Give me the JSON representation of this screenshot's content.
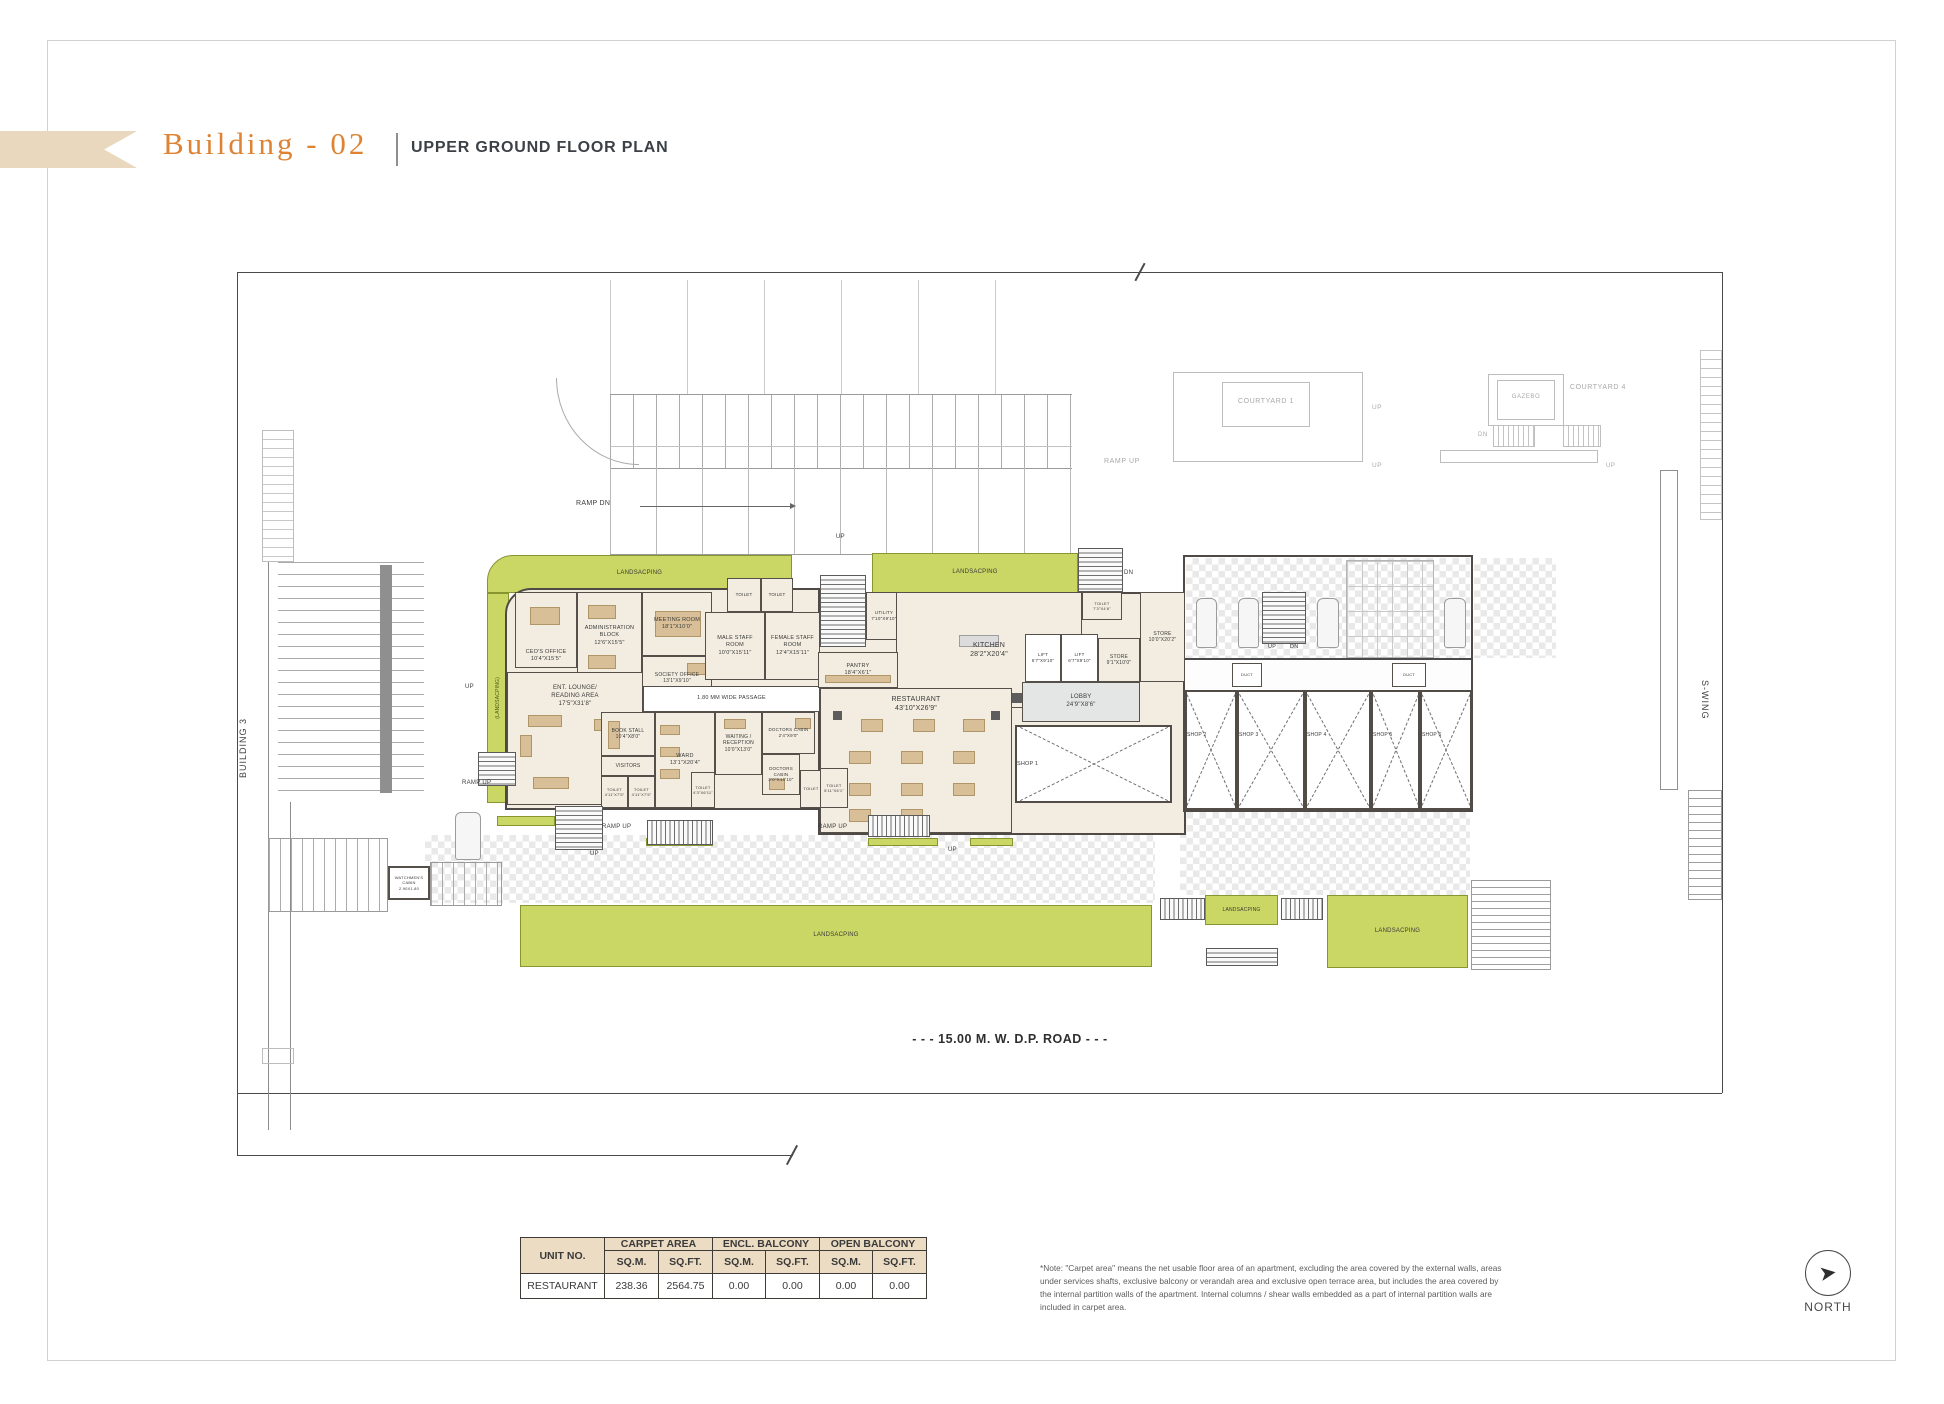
{
  "header": {
    "building_title": "Building - 02",
    "plan_title": "UPPER GROUND FLOOR PLAN"
  },
  "plan": {
    "rooms": {
      "ceo": "CEO'S OFFICE\n10'4\"X15'5\"",
      "admin": "ADMINISTRATION\nBLOCK\n12'6\"X15'5\"",
      "meeting": "MEETING ROOM\n18'1\"X10'0\"",
      "society": "SOCIETY OFFICE\n13'1\"X9'10\"",
      "male_staff": "MALE STAFF\nROOM\n10'0\"X15'11\"",
      "female_staff": "FEMALE STAFF\nROOM\n12'4\"X15'11\"",
      "utility": "UTILITY\n7'10\"X9'10\"",
      "kitchen": "KITCHEN\n28'2\"X20'4\"",
      "toilet_kitchen": "TOILET\n7'3\"X4'6\"",
      "lift": "LIFT\n6'7\"X9'10\"",
      "store_small": "STORE\n9'1\"X10'0\"",
      "store_big": "STORE\n10'0\"X20'2\"",
      "lobby": "LOBBY\n24'9\"X8'6\"",
      "pantry": "PANTRY\n18'4\"X6'1\"",
      "restaurant": "RESTAURANT\n43'10\"X26'9\"",
      "lounge": "ENT. LOUNGE/\nREADING AREA\n17'5\"X31'8\"",
      "passage": "1.80 MM WIDE PASSAGE",
      "book_stall": "BOOK STALL\n10'4\"X8'0\"",
      "visitors": "VISITORS",
      "ward": "WARD\n13'1\"X20'4\"",
      "waiting": "WAITING /\nRECEPTION\n10'0\"X13'0\"",
      "doctors1": "DOCTORS CABIN\n2'4\"X9'0\"",
      "doctors2": "DOCTORS CABIN\n2'0\"X10'10\"",
      "toilet": "TOILET",
      "toilet_small": "TOILET\n4'11\"X7'5\"",
      "toilet_ward": "TOILET\n4'3\"X6'11\"",
      "toilet_rest": "TOILET\n5'11\"X6'1\"",
      "duct": "DUCT",
      "watchmen": "WATCHMEN'S\nCABIN\n2.90X1.80"
    },
    "shops": [
      "SHOP 1",
      "SHOP 2",
      "SHOP 3",
      "SHOP 4",
      "SHOP 5",
      "SHOP 6"
    ],
    "site": {
      "landsacping": "LANDSACPING",
      "landsacping_v": "(LANDSACPING)",
      "ramp_up": "RAMP UP",
      "ramp_dn": "RAMP DN",
      "up": "UP",
      "dn": "DN",
      "courtyard1": "COURTYARD 1",
      "courtyard4": "COURTYARD 4",
      "gazebo": "GAZEBO",
      "building3": "BUILDING 3",
      "s_wing": "S-WING",
      "road": "- - - 15.00 M. W. D.P. ROAD  - - -"
    }
  },
  "area_table": {
    "col_unit": "UNIT NO.",
    "col_carpet": "CARPET AREA",
    "col_encl": "ENCL. BALCONY",
    "col_open": "OPEN BALCONY",
    "sqm": "SQ.M.",
    "sqft": "SQ.FT.",
    "row": {
      "unit": "RESTAURANT",
      "carpet_sqm": "238.36",
      "carpet_sqft": "2564.75",
      "encl_sqm": "0.00",
      "encl_sqft": "0.00",
      "open_sqm": "0.00",
      "open_sqft": "0.00"
    }
  },
  "note": "*Note: \"Carpet area\" means the net usable floor area of an apartment, excluding the area covered by the external walls, areas under services shafts, exclusive balcony or verandah area and exclusive open terrace area, but includes the area covered by the internal partition walls of the apartment. Internal columns / shear walls embedded as a part of internal partition walls are included in carpet area.",
  "north_label": "NORTH",
  "icons": {
    "north_arrow": "➤"
  }
}
